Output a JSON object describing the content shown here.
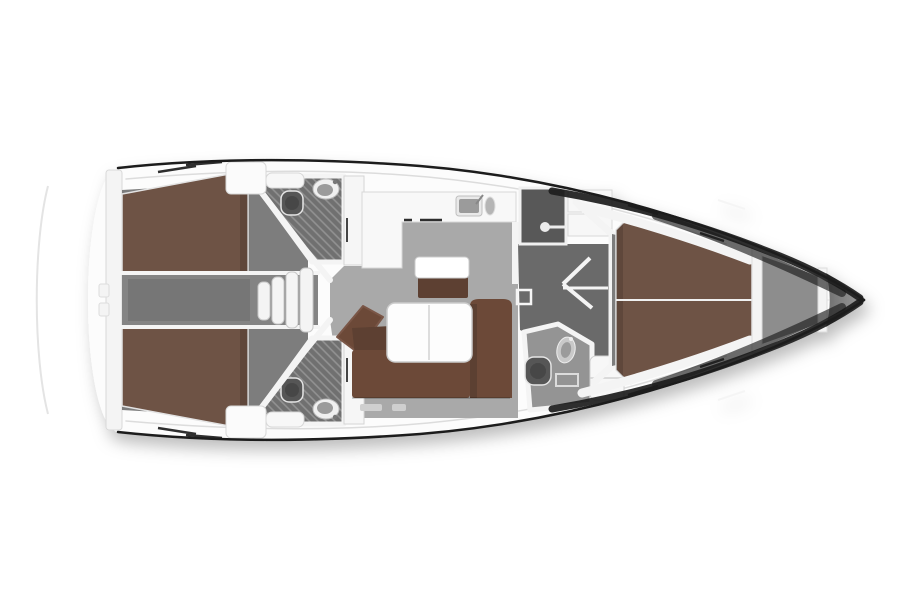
{
  "diagram": {
    "type": "yacht-interior-floor-plan",
    "view": "top-down",
    "orientation": "bow-right"
  },
  "colors": {
    "background": "#ffffff",
    "hull_outline": "#1c1c1c",
    "hull_fill": "#fcfcfc",
    "deck_line": "#dcdcdc",
    "platform_line": "#e4e4e4",
    "wall": "#f4f4f4",
    "wall_edge": "#d6d6d6",
    "floor": "#a9a9a9",
    "floor_dark": "#6a6a6a",
    "cabin_floor": "#7d7d7d",
    "corridor": "#848484",
    "engine_hatch": "#767676",
    "head_floor": "#949494",
    "hatch_base": "#6f6f6f",
    "hatch_line": "#929292",
    "berth": "#6e5244",
    "berth_shade": "rgba(0,0,0,0.14)",
    "sofa": "#6c4a39",
    "sofa_dark": "#5d4030",
    "table": "#fdfdfd",
    "seat_top": "#ffffff",
    "wardrobe": "#595959",
    "anchor_locker": "#8d8d8d",
    "bow_tip": "#828282",
    "fixture_dark": "#565656",
    "fixture_darker": "#474747",
    "fixture_mid": "#9b9b9b",
    "fixture_light": "#ececec",
    "step": "#f4f4f4",
    "detail_dark": "#2e2e2e",
    "locker_handle": "#cfcfcf"
  },
  "rooms": [
    {
      "name": "aft-cabin-port",
      "feature": "double-berth"
    },
    {
      "name": "aft-cabin-starboard",
      "feature": "double-berth"
    },
    {
      "name": "aft-head-port",
      "features": "toilet, sink, shower"
    },
    {
      "name": "aft-head-starboard",
      "features": "toilet, sink, shower"
    },
    {
      "name": "companionway",
      "feature": "steps"
    },
    {
      "name": "engine-box-corridor",
      "feature": "hatch"
    },
    {
      "name": "saloon",
      "features": "u-sofa, table, seat"
    },
    {
      "name": "galley",
      "features": "l-counter, sink"
    },
    {
      "name": "wardrobe",
      "feature": "hanging-rail"
    },
    {
      "name": "forward-corridor",
      "feature": "door-swing"
    },
    {
      "name": "forward-head",
      "features": "toilet, sink, shower"
    },
    {
      "name": "forward-cabin",
      "feature": "v-berth"
    },
    {
      "name": "anchor-locker",
      "feature": "bow-compartment"
    }
  ]
}
